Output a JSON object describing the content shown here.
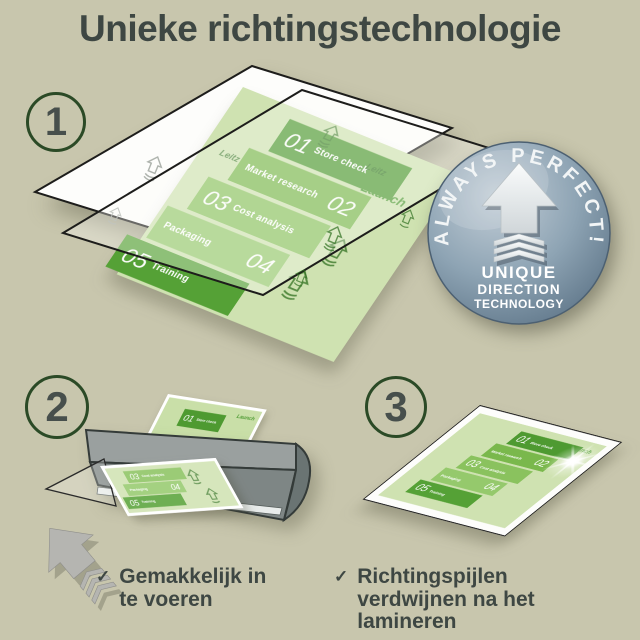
{
  "title": "Unieke richtingstechnologie",
  "steps": [
    {
      "number": "1"
    },
    {
      "number": "2"
    },
    {
      "number": "3"
    }
  ],
  "badge": {
    "arc_text": "ALWAYS PERFECT!",
    "lines": [
      "UNIQUE",
      "DIRECTION",
      "TECHNOLOGY"
    ]
  },
  "document": {
    "rows": [
      {
        "num": "01",
        "label": "Store check"
      },
      {
        "num": "02",
        "label": "Market research"
      },
      {
        "num": "03",
        "label": "Cost analysis"
      },
      {
        "num": "04",
        "label": "Packaging"
      },
      {
        "num": "05",
        "label": "Training"
      }
    ],
    "corner_label": "Launch",
    "watermark": "Leitz"
  },
  "checklist": [
    {
      "text": "Gemakkelijk in te voeren"
    },
    {
      "text": "Richtingspijlen verdwijnen na het lamineren"
    }
  ],
  "icons": {
    "check": "✓",
    "direction_arrow": "up-arrow-with-chevrons"
  },
  "colors": {
    "background": "#c8c6ad",
    "text": "#3e4743",
    "accent_green_dark": "#4e9a31",
    "accent_green_mid": "#7ab84c",
    "accent_green_light": "#95c96c",
    "doc_background": "#cfe2b1",
    "badge_blue": "#8399ab",
    "laminator_gray": "#8a9190",
    "arrow_gray": "#b5b5b1"
  }
}
